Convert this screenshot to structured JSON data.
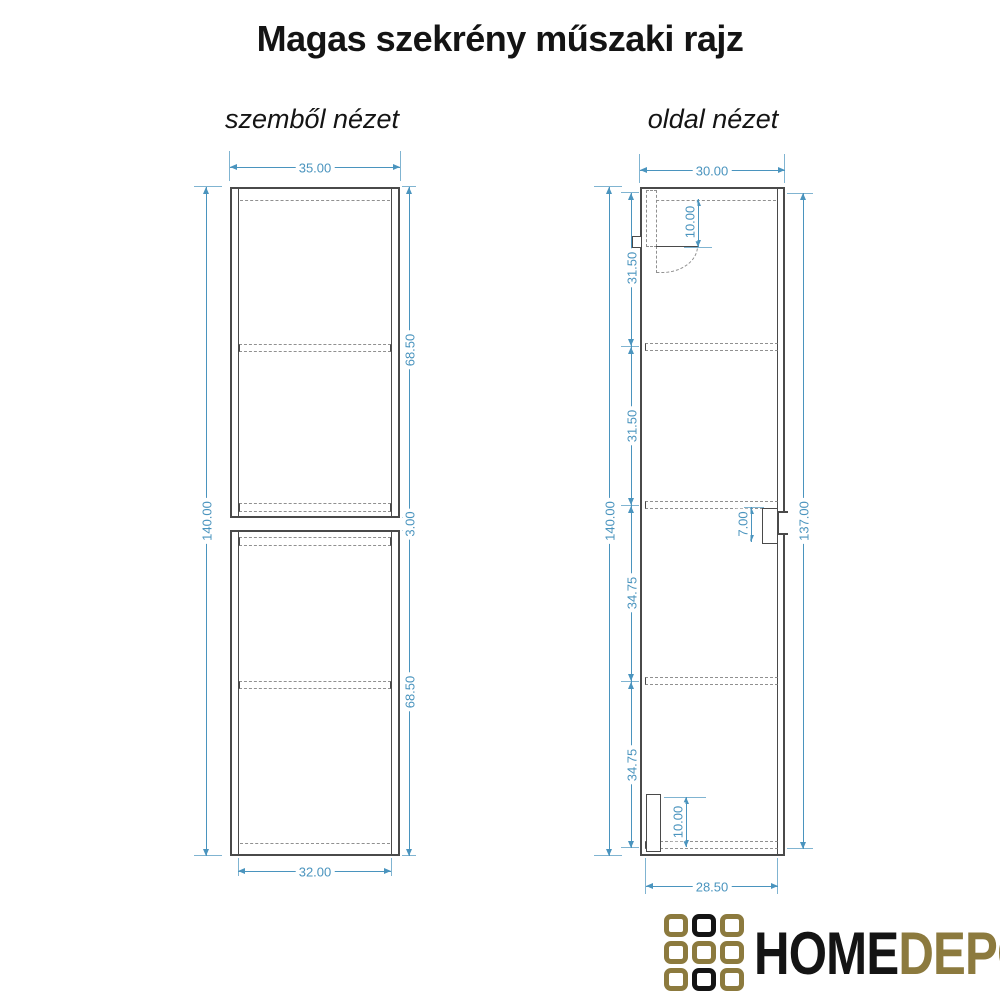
{
  "title": "Magas szekrény műszaki rajz",
  "front": {
    "label": "szemből nézet",
    "dims": {
      "width_top": "35.00",
      "height_left": "140.00",
      "upper_right": "68.50",
      "gap_right": "3.00",
      "lower_right": "68.50",
      "width_bottom": "32.00"
    }
  },
  "side": {
    "label": "oldal nézet",
    "dims": {
      "width_top": "30.00",
      "height_left": "140.00",
      "seg_1": "31.50",
      "seg_2": "31.50",
      "seg_3": "34.75",
      "seg_4": "34.75",
      "height_right": "137.00",
      "width_bottom": "28.50",
      "top_bracket": "10.00",
      "handle_recess": "7.00",
      "bottom_plinth": "10.00"
    }
  },
  "logo": {
    "word_1": "HOME",
    "word_2": "DEPO",
    "colors": {
      "gold": "#8c7a3e",
      "black": "#141414"
    },
    "grid": [
      [
        "gold",
        "black",
        "gold"
      ],
      [
        "gold",
        "gold",
        "gold"
      ],
      [
        "gold",
        "black",
        "gold"
      ]
    ]
  },
  "colors": {
    "dimension": "#4a94be",
    "line": "#4a4a4a",
    "hidden_line": "#909090",
    "background": "#ffffff",
    "title_text": "#141414"
  }
}
